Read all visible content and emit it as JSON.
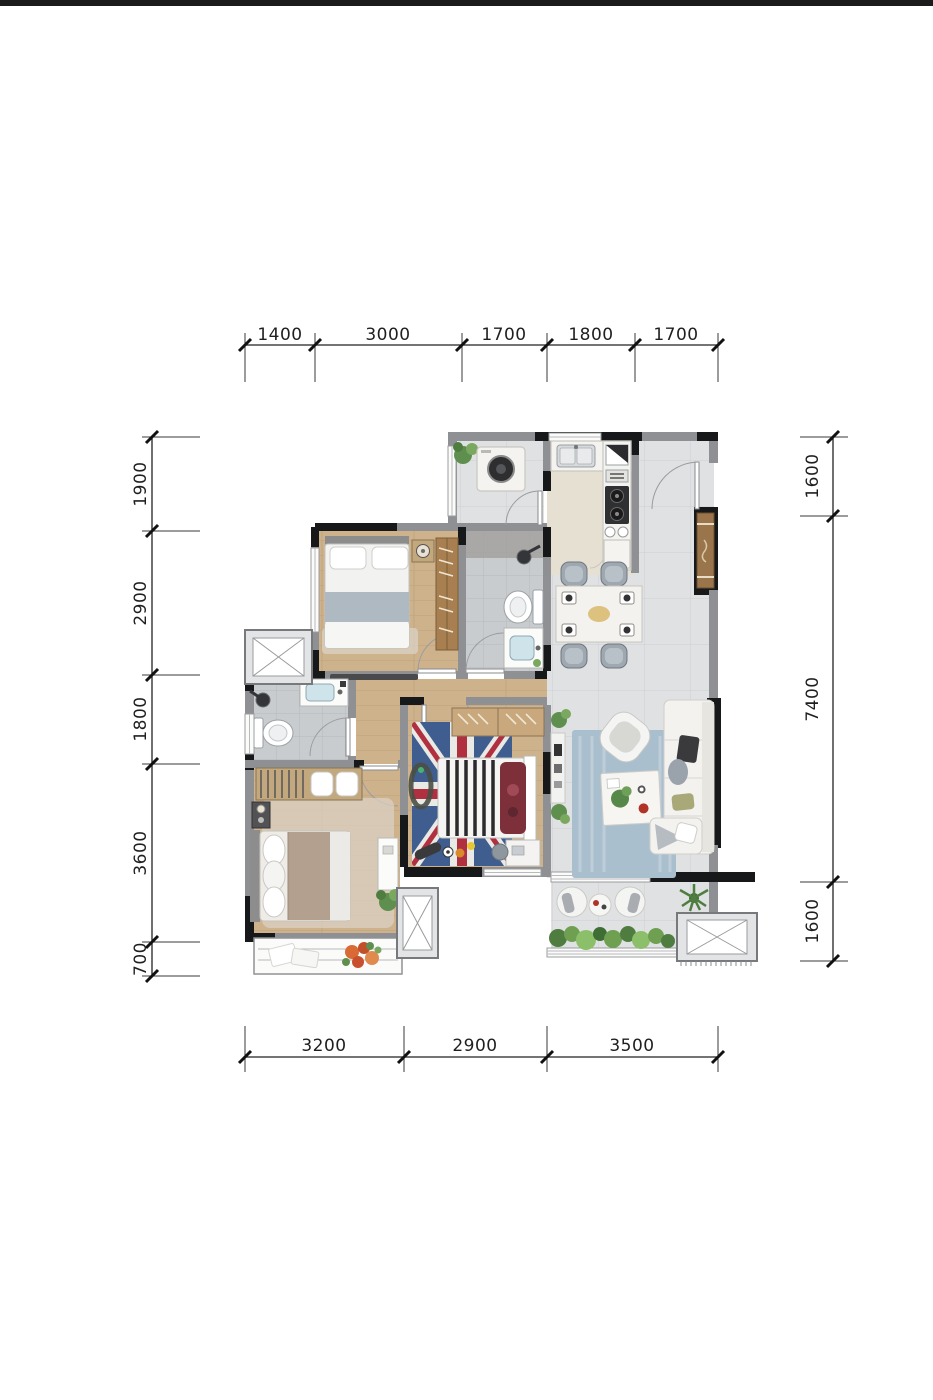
{
  "page": {
    "background": "#ffffff",
    "top_border_color": "#1b1b1b"
  },
  "floor_plan": {
    "kind": "residential-apartment-floor-plan",
    "units": "mm",
    "dimensions_mm": {
      "top": [
        "1400",
        "3000",
        "1700",
        "1800",
        "1700"
      ],
      "bottom": [
        "3200",
        "2900",
        "3500"
      ],
      "left": [
        "1900",
        "2900",
        "1800",
        "3600",
        "700"
      ],
      "right": [
        "1600",
        "7400",
        "1600"
      ]
    },
    "colors": {
      "wall_gray": "#8f9093",
      "wall_black": "#17181a",
      "tile_floor": "#dfe1e3",
      "bath_tile": "#c9ccce",
      "wood_floor": "#c9ad88",
      "kitchen_floor": "#e6e0d2",
      "kids_rug_blue": "#3f5d8e",
      "living_rug_blue": "#a9bfce",
      "cabinet_wood": "#9a744a",
      "greenery_green": "#5f8f4f",
      "dimension_text": "#1f1f1f"
    }
  }
}
